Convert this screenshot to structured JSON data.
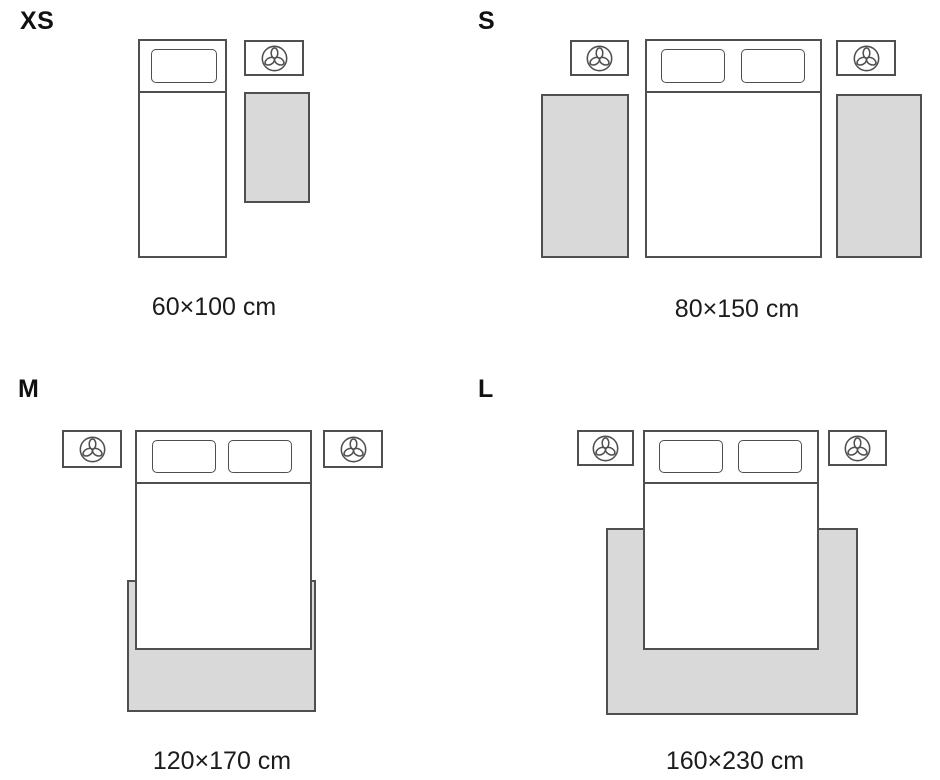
{
  "colors": {
    "background": "#ffffff",
    "outline": "#4f4f4f",
    "rug_fill": "#d9d9d9",
    "text": "#1c1c1c"
  },
  "icons": {
    "nightstand_icon": "lamp-plant-top-view-icon"
  },
  "sizes": [
    {
      "label": "XS",
      "caption": "60×100 cm"
    },
    {
      "label": "S",
      "caption": "80×150 cm"
    },
    {
      "label": "M",
      "caption": "120×170 cm"
    },
    {
      "label": "L",
      "caption": "160×230 cm"
    }
  ]
}
